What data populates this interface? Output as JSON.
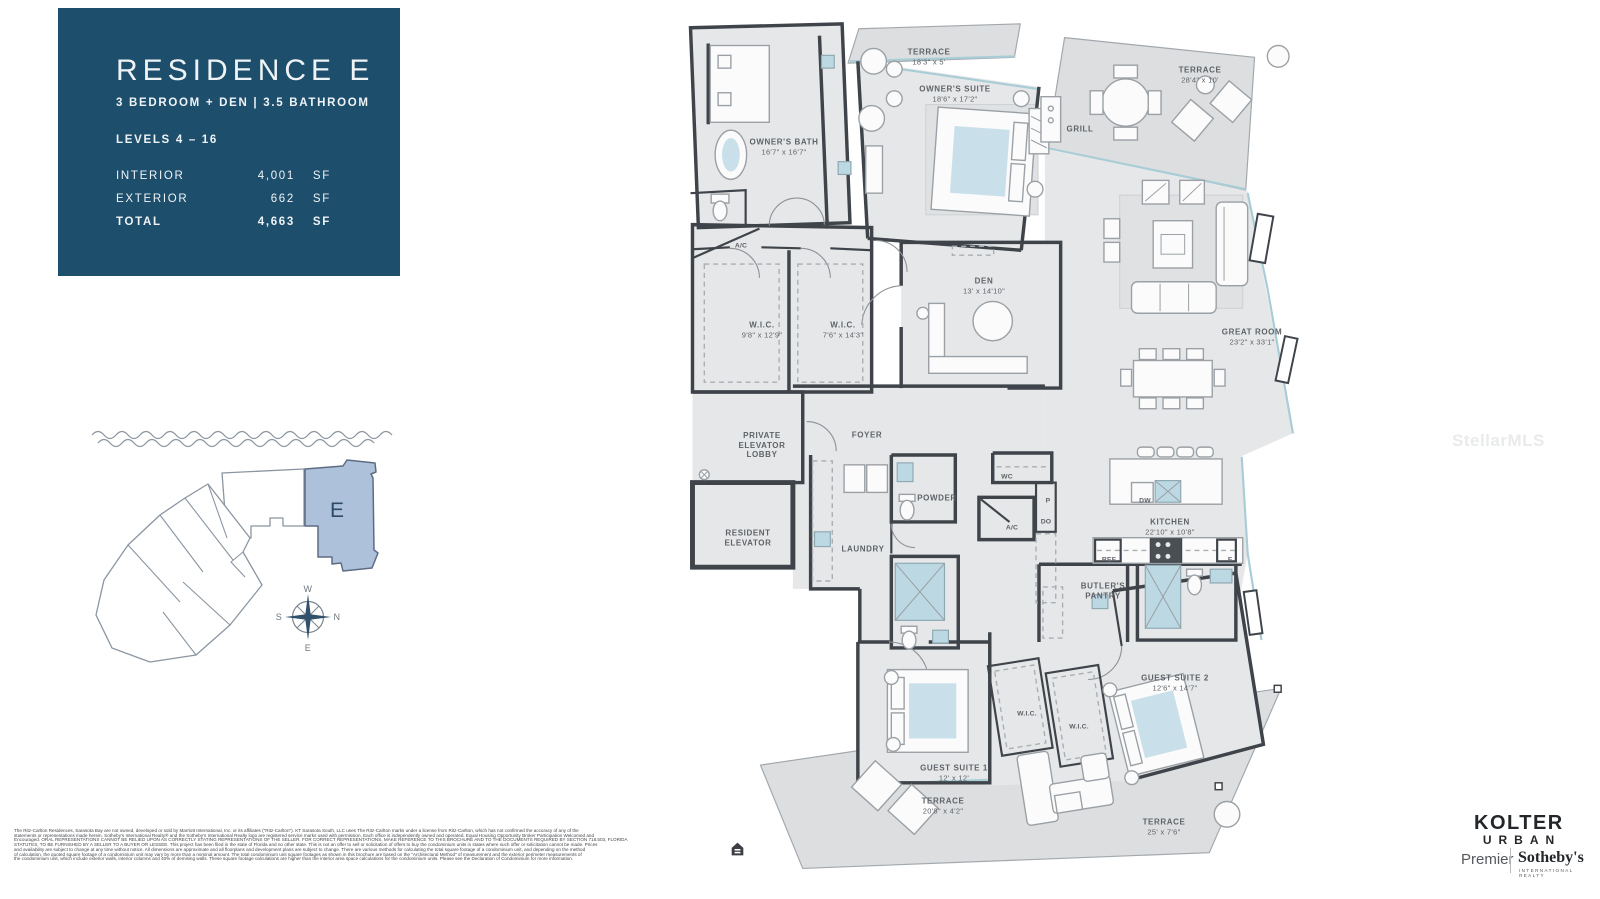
{
  "info_panel": {
    "title": "RESIDENCE E",
    "subtitle": "3 BEDROOM + DEN | 3.5 BATHROOM",
    "levels": "LEVELS 4 – 16",
    "area_rows": [
      {
        "label": "INTERIOR",
        "value": "4,001",
        "unit": "SF"
      },
      {
        "label": "EXTERIOR",
        "value": "662",
        "unit": "SF"
      },
      {
        "label": "TOTAL",
        "value": "4,663",
        "unit": "SF"
      }
    ]
  },
  "site_plan": {
    "unit_label": "E",
    "compass": {
      "top": "W",
      "left": "S",
      "right": "N",
      "bottom": "E"
    }
  },
  "floor_plan": {
    "rooms": [
      {
        "id": "terrace-top",
        "name": "TERRACE",
        "dims": "18'3\" x 5'",
        "x": 929,
        "y": 57
      },
      {
        "id": "owners-suite",
        "name": "OWNER'S SUITE",
        "dims": "18'6\" x 17'2\"",
        "x": 955,
        "y": 94
      },
      {
        "id": "terrace-ne",
        "name": "TERRACE",
        "dims": "28'4\" x 10'",
        "x": 1200,
        "y": 75
      },
      {
        "id": "grill",
        "name": "GRILL",
        "dims": "",
        "x": 1080,
        "y": 129
      },
      {
        "id": "owners-bath",
        "name": "OWNER'S BATH",
        "dims": "16'7\" x 16'7\"",
        "x": 784,
        "y": 147
      },
      {
        "id": "ac-top",
        "name": "A/C",
        "dims": "",
        "x": 741,
        "y": 246,
        "small": true
      },
      {
        "id": "wic-1",
        "name": "W.I.C.",
        "dims": "9'8\" x 12'9\"",
        "x": 762,
        "y": 330
      },
      {
        "id": "wic-2",
        "name": "W.I.C.",
        "dims": "7'6\" x 14'3\"",
        "x": 843,
        "y": 330
      },
      {
        "id": "den",
        "name": "DEN",
        "dims": "13' x 14'10\"",
        "x": 984,
        "y": 286
      },
      {
        "id": "great-room",
        "name": "GREAT ROOM",
        "dims": "23'2\" x 33'1\"",
        "x": 1252,
        "y": 337
      },
      {
        "id": "private-elevator-lobby",
        "name": "PRIVATE\nELEVATOR\nLOBBY",
        "dims": "",
        "x": 762,
        "y": 445
      },
      {
        "id": "foyer",
        "name": "FOYER",
        "dims": "",
        "x": 867,
        "y": 435
      },
      {
        "id": "resident-elevator",
        "name": "RESIDENT\nELEVATOR",
        "dims": "",
        "x": 748,
        "y": 538
      },
      {
        "id": "laundry",
        "name": "LAUNDRY",
        "dims": "",
        "x": 863,
        "y": 549
      },
      {
        "id": "powder",
        "name": "POWDER",
        "dims": "",
        "x": 937,
        "y": 498
      },
      {
        "id": "wc",
        "name": "WC",
        "dims": "",
        "x": 1007,
        "y": 477,
        "small": true
      },
      {
        "id": "pantry-p",
        "name": "P",
        "dims": "",
        "x": 1048,
        "y": 501,
        "small": true
      },
      {
        "id": "do",
        "name": "DO",
        "dims": "",
        "x": 1046,
        "y": 522,
        "small": true
      },
      {
        "id": "ac-mid",
        "name": "A/C",
        "dims": "",
        "x": 1012,
        "y": 528,
        "small": true
      },
      {
        "id": "kitchen",
        "name": "KITCHEN",
        "dims": "22'10\" x 10'8\"",
        "x": 1170,
        "y": 527
      },
      {
        "id": "dw",
        "name": "DW",
        "dims": "",
        "x": 1145,
        "y": 501,
        "small": true
      },
      {
        "id": "ref",
        "name": "REF",
        "dims": "",
        "x": 1109,
        "y": 560,
        "small": true
      },
      {
        "id": "f",
        "name": "F",
        "dims": "",
        "x": 1230,
        "y": 560,
        "small": true
      },
      {
        "id": "butlers-pantry",
        "name": "BUTLER'S\nPANTRY",
        "dims": "",
        "x": 1103,
        "y": 591
      },
      {
        "id": "guest-suite-2",
        "name": "GUEST SUITE 2",
        "dims": "12'6\" x 14'7\"",
        "x": 1175,
        "y": 683
      },
      {
        "id": "wic-3",
        "name": "W.I.C.",
        "dims": "",
        "x": 1027,
        "y": 714,
        "small": true
      },
      {
        "id": "wic-4",
        "name": "W.I.C.",
        "dims": "",
        "x": 1079,
        "y": 727,
        "small": true
      },
      {
        "id": "guest-suite-1",
        "name": "GUEST SUITE 1",
        "dims": "12' x 12'",
        "x": 954,
        "y": 773
      },
      {
        "id": "terrace-sw",
        "name": "TERRACE",
        "dims": "20'8\" x 4'2\"",
        "x": 943,
        "y": 806
      },
      {
        "id": "terrace-se",
        "name": "TERRACE",
        "dims": "25' x 7'6\"",
        "x": 1164,
        "y": 827
      }
    ]
  },
  "watermark": "StellarMLS",
  "footer": {
    "disclaimer_lines": [
      "The Ritz-Carlton Residences, Sarasota Bay are not owned, developed or sold by Marriott International, Inc. or its affiliates (\"Ritz-Carlton\"). KT Sarasota South, LLC uses The Ritz-Carlton marks under a license from Ritz-Carlton, which has not confirmed the accuracy of any of the",
      "statements or representations made herein. Sotheby's International Realty® and the Sotheby's International Realty logo are registered service marks used with permission. Each office is independently owned and operated. Equal Housing Opportunity Broker Participation Welcomed and",
      "Encouraged. ORAL REPRESENTATIONS CANNOT BE RELIED UPON AS CORRECTLY STATING REPRESENTATIONS OF THE SELLER. FOR CORRECT REPRESENTATIONS, MAKE REFERENCE TO THIS BROCHURE AND TO THE DOCUMENTS REQUIRED BY SECTION 718.503, FLORIDA",
      "STATUTES, TO BE FURNISHED BY A SELLER TO A BUYER OR LESSEE. This project has been filed in the state of Florida and no other state. This is not an offer to sell or solicitation of offers to buy the condominium units in states where such offer or solicitation cannot be made. Prices",
      "and availability are subject to change at any time without notice. All dimensions are approximate and all floorplans and development plans are subject to change. There are various methods for calculating the total square footage of a condominium unit, and depending on the method",
      "of calculation, the quoted square footage of a condominium unit may vary by more than a nominal amount. The total condominium unit square footages as shown in this brochure are based on the \"Architectural Method\" of measurement and the exterior perimeter measurements of",
      "the condominium unit, which include exterior walls, interior columns and 40% of demising walls. These square footage calculations are higher than the interior area space calculations for the condominium units. Please see the Declaration of Condominium for more information."
    ],
    "kolter_line1": "KOLTER",
    "kolter_line2": "URBAN",
    "premier": "Premier",
    "sothebys": "Sotheby's",
    "sothebys_sub": "INTERNATIONAL REALTY"
  },
  "colors": {
    "panel_bg": "#1d4e6c",
    "unit_highlight": "#aec1da",
    "glass": "#a9cdd6",
    "wall": "#3f444a"
  }
}
